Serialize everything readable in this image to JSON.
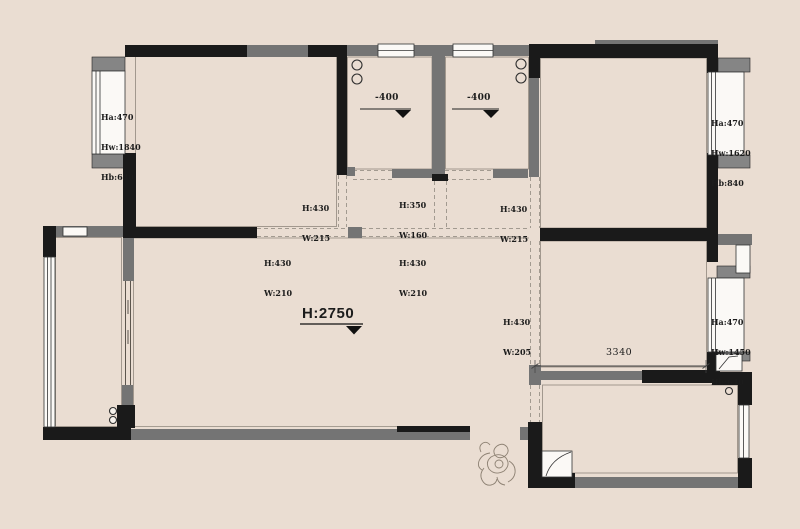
{
  "colors": {
    "background": "#eaddd2",
    "wall_primary": "#1a1a1a",
    "wall_secondary": "#747474",
    "window_fill": "#fbf9f6",
    "dashed_line": "#a29a90",
    "text": "#1c1c1c"
  },
  "ceiling_marker": {
    "label": "H:2750"
  },
  "floor_level_markers": {
    "left": "-400",
    "right": "-400"
  },
  "dimension": {
    "label": "3340"
  },
  "window_annotations": {
    "left": {
      "line1": "Ha:470",
      "line2": "Hw:1840",
      "line3": "Hb:640"
    },
    "top_right": {
      "line1": "Ha:470",
      "line2": "Hw:1620",
      "line3": "Hb:840"
    },
    "mid_right": {
      "line1": "Ha:470",
      "line2": "Hw:1450",
      "line3": "Hb:640"
    }
  },
  "opening_annotations": {
    "o1": {
      "h": "H:430",
      "w": "W:215"
    },
    "o2": {
      "h": "H:350",
      "w": "W:160"
    },
    "o3": {
      "h": "H:430",
      "w": "W:215"
    },
    "o4": {
      "h": "H:430",
      "w": "W:210"
    },
    "o5": {
      "h": "H:430",
      "w": "W:210"
    },
    "o6": {
      "h": "H:430",
      "w": "W:205"
    }
  },
  "symbols": {
    "pipe_circles": "pipe-circle-icon",
    "person": "person-sketch",
    "door_swing": "door-swing-icon",
    "elevation_triangle": "elevation-marker-icon"
  }
}
